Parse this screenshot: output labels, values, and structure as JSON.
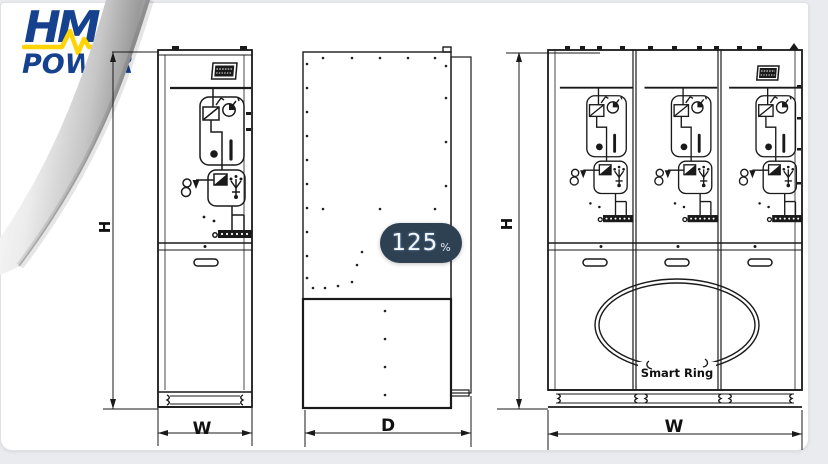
{
  "window": {
    "outer_background": "#e9ebee",
    "card_background": "#ffffff",
    "drawing_line_color": "#1a1a1a"
  },
  "logo": {
    "brand": "HM",
    "subtitle": "POWER",
    "text_color": "#15418f",
    "pulse_color": "#ffd400"
  },
  "zoom_indicator": {
    "value": "125",
    "unit": "%",
    "background": "#2e4153"
  },
  "diagram": {
    "single_front_view": {
      "height_label": "H",
      "width_label": "W"
    },
    "side_view": {
      "depth_label": "D"
    },
    "triple_front_view": {
      "height_label": "H",
      "width_label": "W",
      "ring_label": "Smart Ring",
      "panel_count": 3
    },
    "symbol_icons": [
      "nameplate",
      "busbar",
      "load-break-switch",
      "pressure-gauge",
      "indicator-lamps",
      "earthing-switch",
      "cable-terminal-strip",
      "door-handle",
      "ring-main-loop",
      "dimension-arrow",
      "page-curl",
      "heartbeat-line"
    ]
  }
}
